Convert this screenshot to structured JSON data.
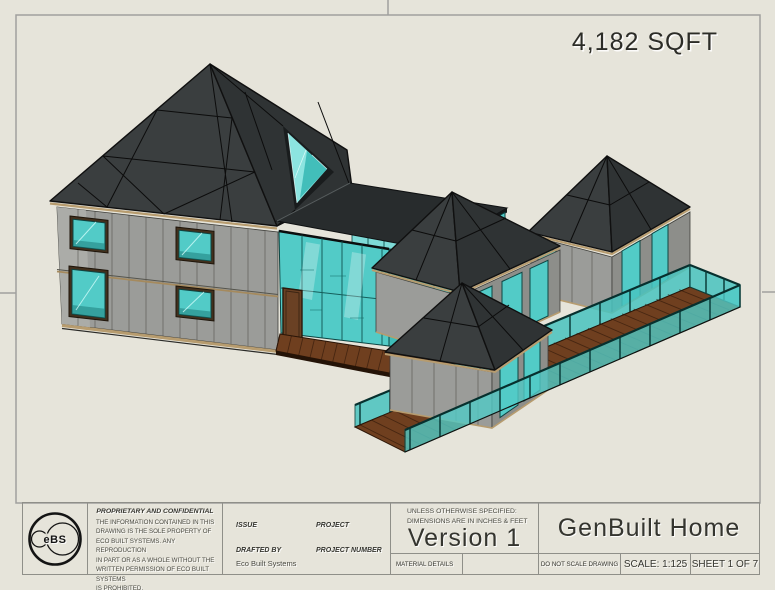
{
  "palette": {
    "background": "#e6e4da",
    "frame_line": "#a0a09e",
    "text": "#35352f",
    "roof": "#3a3e3f",
    "roof_dark": "#2f3334",
    "glass": "#52cbc7",
    "trim": "#b79c6f",
    "deck": "#6f3f1f"
  },
  "sheet": {
    "area_label": "4,182 SQFT"
  },
  "title_block": {
    "logo_text": "eBS",
    "proprietary": {
      "title": "PROPRIETARY AND CONFIDENTIAL",
      "body": "THE INFORMATION CONTAINED IN THIS\nDRAWING IS THE SOLE PROPERTY OF\nECO BUILT SYSTEMS.  ANY REPRODUCTION\nIN PART OR AS A WHOLE WITHOUT THE\nWRITTEN PERMISSION OF ECO BUILT SYSTEMS\nIS PROHIBITED."
    },
    "fields": {
      "issue_label": "ISSUE",
      "project_label": "PROJECT",
      "drafted_by_label": "DRAFTED BY",
      "drafted_by_value": "Eco Built Systems",
      "project_number_label": "PROJECT NUMBER"
    },
    "spec_note_line1": "UNLESS OTHERWISE SPECIFIED:",
    "spec_note_line2": "DIMENSIONS ARE IN INCHES & FEET",
    "version": "Version 1",
    "material_details_label": "MATERIAL DETAILS",
    "drawing_title": "GenBuilt Home",
    "do_not_scale": "DO NOT SCALE DRAWING",
    "scale": "SCALE: 1:125",
    "sheet_number": "SHEET 1 OF 7"
  }
}
